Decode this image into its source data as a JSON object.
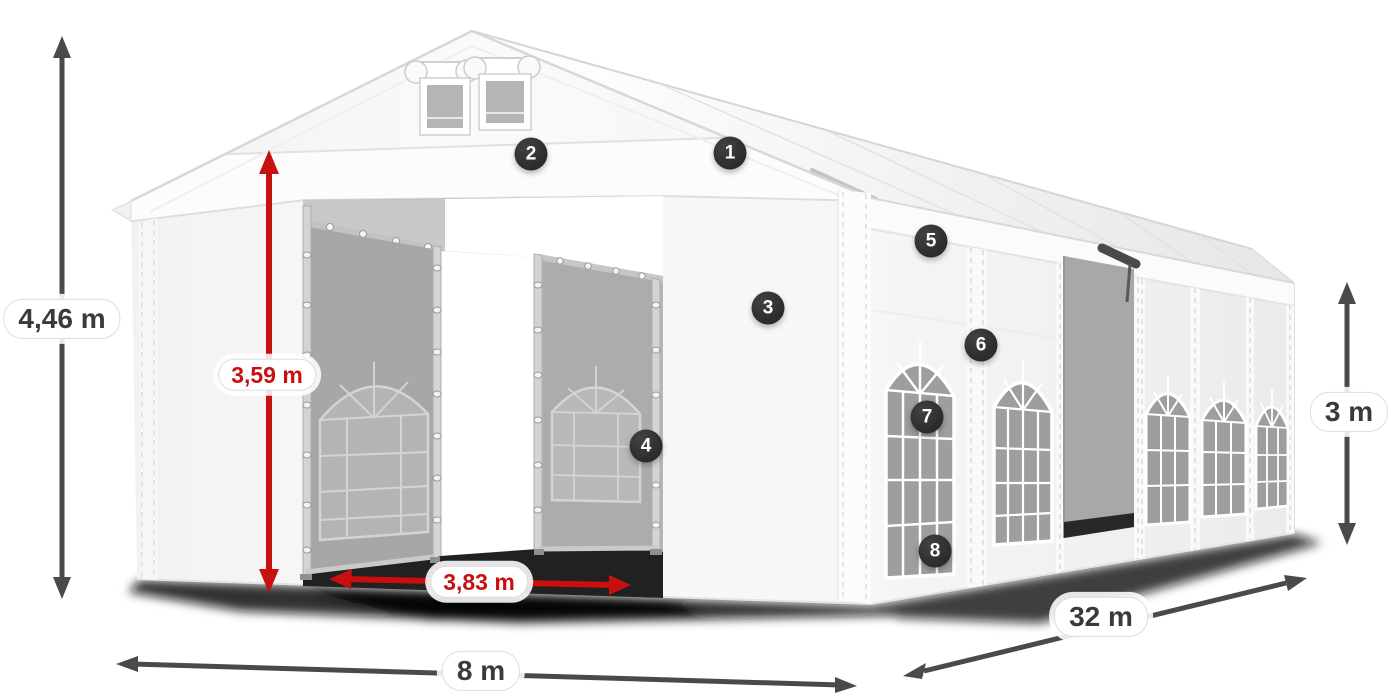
{
  "colors": {
    "dimension_red": "#c81010",
    "arrow_dark": "#4a4a4a",
    "label_text": "#3a3a3a",
    "marker_bg": "#2b2b2b",
    "marker_text": "#ffffff",
    "pill_bg": "#ffffff",
    "pill_border": "#dddddd",
    "tent_white": "#f7f7f7",
    "interior_gray": "#a8a8a8",
    "shadow_dark": "#111111"
  },
  "dimensions": {
    "total_height": {
      "value": "4,46 m",
      "style": "dark"
    },
    "entrance_height": {
      "value": "3,59 m",
      "style": "red"
    },
    "entrance_width": {
      "value": "3,83 m",
      "style": "red"
    },
    "front_width": {
      "value": "8 m",
      "style": "dark"
    },
    "side_length": {
      "value": "32 m",
      "style": "dark"
    },
    "side_height": {
      "value": "3 m",
      "style": "dark"
    }
  },
  "markers": [
    "1",
    "2",
    "3",
    "4",
    "5",
    "6",
    "7",
    "8"
  ]
}
